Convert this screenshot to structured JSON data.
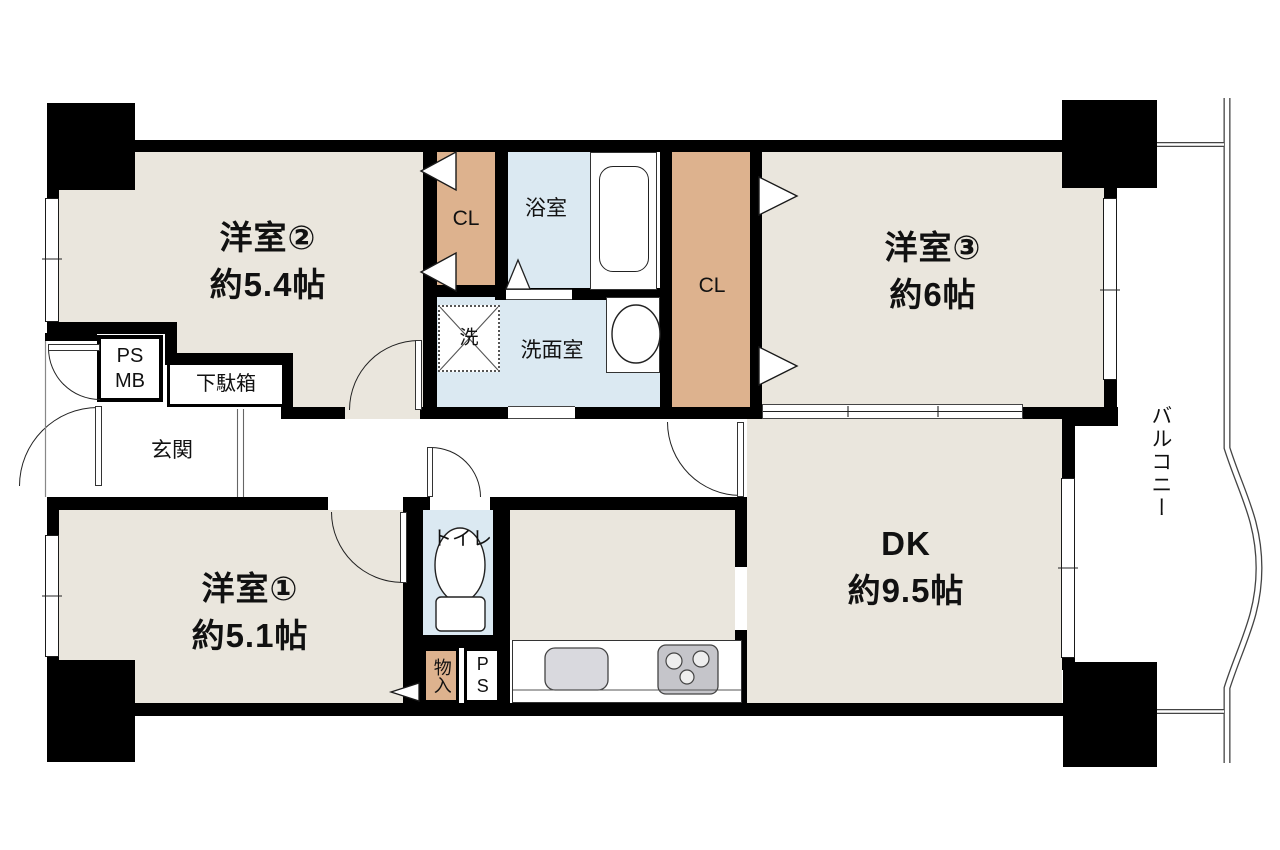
{
  "colors": {
    "wall": "#000000",
    "floor_beige": "#eae6dd",
    "closet_tan": "#ddb28e",
    "wet_blue": "#dbe9f2",
    "counter_sink_gray": "#d9d9de",
    "stove_gray": "#c5c5ca"
  },
  "rooms": {
    "western2": {
      "name": "洋室②",
      "size": "約5.4帖"
    },
    "western3": {
      "name": "洋室③",
      "size": "約6帖"
    },
    "western1": {
      "name": "洋室①",
      "size": "約5.1帖"
    },
    "dining_kitchen": {
      "name": "DK",
      "size": "約9.5帖"
    },
    "bathroom": {
      "name": "浴室"
    },
    "washroom": {
      "name": "洗面室"
    },
    "washer": {
      "name": "洗"
    },
    "toilet": {
      "name": "トイレ"
    },
    "entrance": {
      "name": "玄関"
    },
    "shoe_cabinet": {
      "name": "下駄箱"
    },
    "ps_mb": {
      "ps": "PS",
      "mb": "MB"
    },
    "closet_west": {
      "name": "CL"
    },
    "closet_east": {
      "name": "CL"
    },
    "storage": {
      "name": "物入"
    },
    "pipe_shaft": {
      "name": "PS"
    },
    "balcony": {
      "name": "バルコニー"
    }
  }
}
